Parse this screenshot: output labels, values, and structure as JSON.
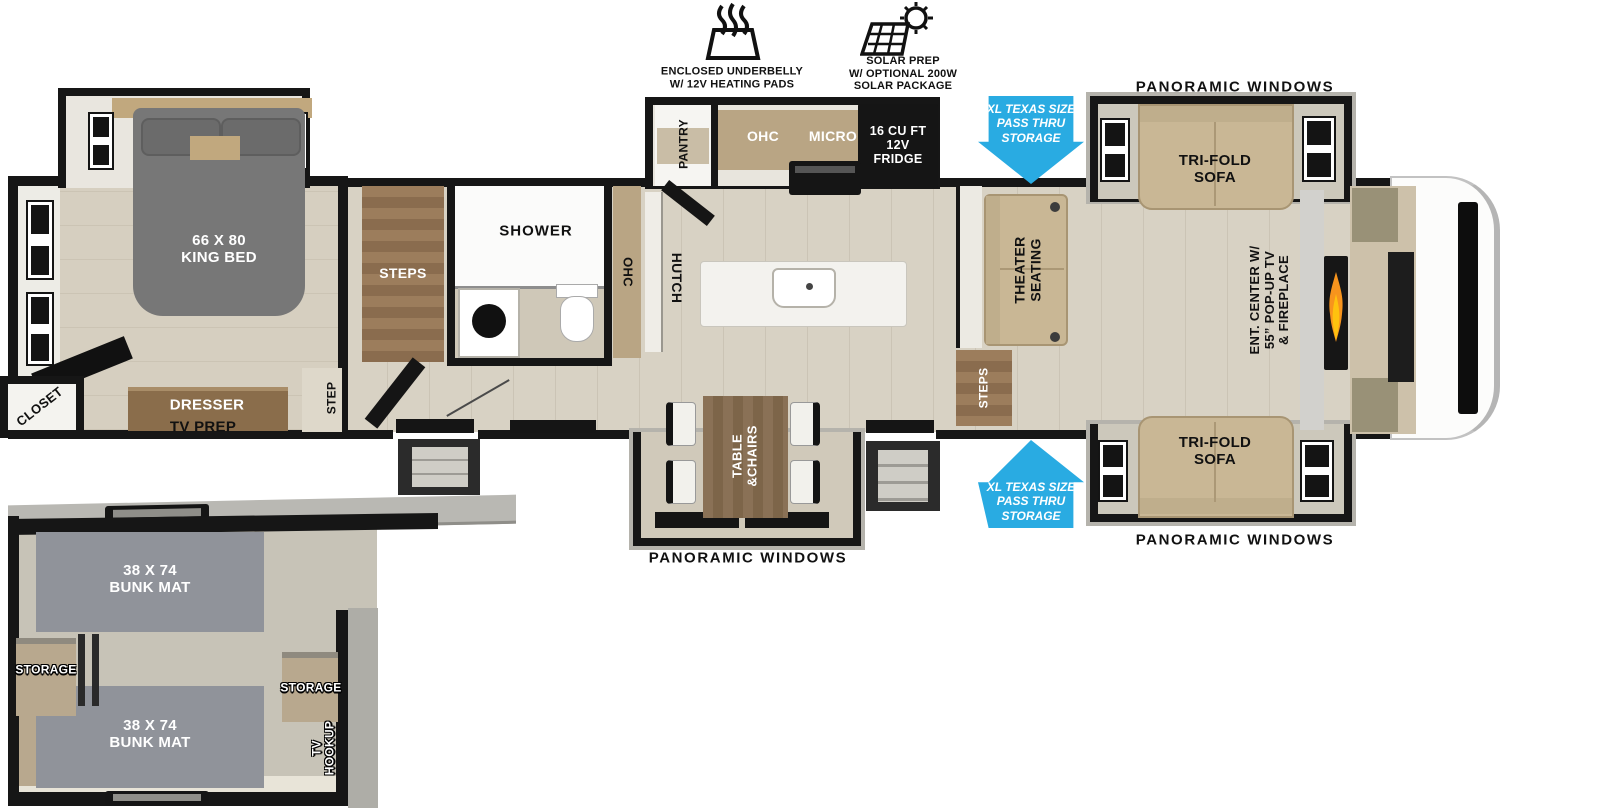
{
  "badges": {
    "underbelly": {
      "icon": "heating-pads-icon",
      "label": "ENCLOSED UNDERBELLY\nW/ 12V HEATING PADS"
    },
    "solar": {
      "icon": "solar-panel-icon",
      "label": "SOLAR PREP\nW/ OPTIONAL 200W\nSOLAR PACKAGE"
    }
  },
  "exterior": {
    "panoramic_top": "PANORAMIC WINDOWS",
    "panoramic_bottom": "PANORAMIC WINDOWS",
    "panoramic_dinette": "PANORAMIC WINDOWS",
    "passthru_top": "XL TEXAS SIZE\nPASS THRU\nSTORAGE",
    "passthru_bottom": "XL TEXAS SIZE\nPASS THRU\nSTORAGE"
  },
  "bedroom": {
    "bed": "66 X 80\nKING BED",
    "dresser": "DRESSER",
    "tv_prep": "TV PREP",
    "closet": "CLOSET",
    "step": "STEP"
  },
  "hall": {
    "steps": "STEPS"
  },
  "bath": {
    "shower": "SHOWER"
  },
  "kitchen": {
    "pantry": "PANTRY",
    "ohc": "OHC",
    "micro": "MICRO",
    "fridge": "16 CU FT\n12V\nFRIDGE",
    "ohc_side": "OHC",
    "hutch": "HUTCH"
  },
  "living": {
    "theater": "THEATER\nSEATING",
    "steps": "STEPS",
    "sofa_top": "TRI-FOLD\nSOFA",
    "sofa_bottom": "TRI-FOLD\nSOFA",
    "ent_center": "ENT. CENTER W/\n55” POP-UP TV\n& FIREPLACE"
  },
  "dinette": {
    "table": "TABLE\n&CHAIRS"
  },
  "bunk_room": {
    "bunk_top": "38 X 74\nBUNK MAT",
    "bunk_bottom": "38 X 74\nBUNK MAT",
    "storage_left": "STORAGE",
    "storage_right": "STORAGE",
    "tv_hookup": "TV\nHOOKUP"
  },
  "colors": {
    "arrow_blue": "#29ABE2",
    "wall_black": "#161616",
    "floor_tan": "#d8d2c4",
    "cabinet_tan": "#b9a584",
    "sofa_tan": "#c9b795",
    "mat_gray": "#90939a",
    "flame_orange": "#f7941d"
  }
}
